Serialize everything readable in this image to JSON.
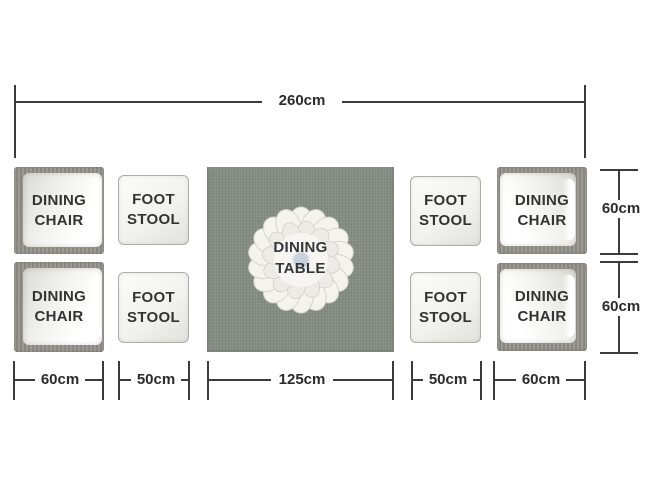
{
  "diagram": {
    "type": "furniture-dimension-plan",
    "furniture": {
      "dining_chair": "DINING\nCHAIR",
      "foot_stool": "FOOT\nSTOOL",
      "dining_table": "DINING\nTABLE",
      "chair_count": 4,
      "stool_count": 4,
      "table_count": 1
    },
    "dimensions": {
      "total_width": "260cm",
      "chair_depth_right_top": "60cm",
      "chair_depth_right_bottom": "60cm",
      "bottom_chair_left": "60cm",
      "bottom_stool_left": "50cm",
      "bottom_table": "125cm",
      "bottom_stool_right": "50cm",
      "bottom_chair_right": "60cm"
    },
    "colors": {
      "background": "#ffffff",
      "table_top": "#868d84",
      "wicker_frame": "#93918a",
      "cushion_white": "#f7f7f4",
      "dimension_line": "#3b3b3b",
      "label_text": "#2b2b2b",
      "centerpiece_center": "#c8d2da"
    }
  }
}
